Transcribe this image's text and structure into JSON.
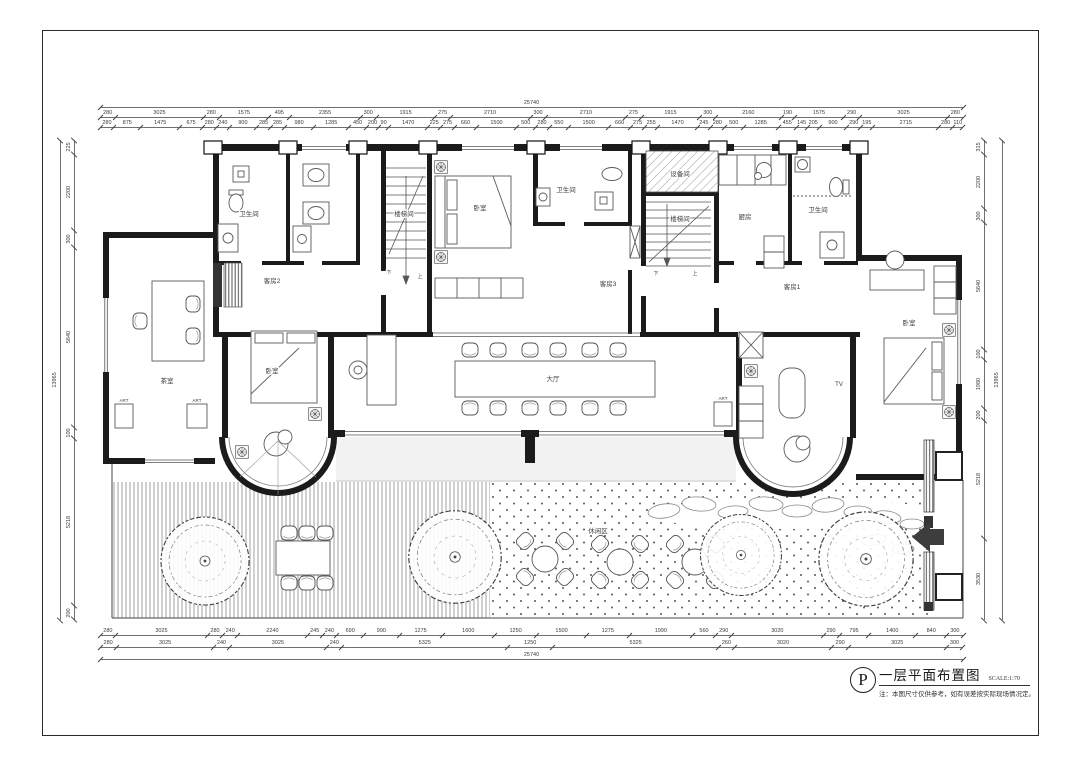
{
  "title_block": {
    "letter": "P",
    "title": "一层平面布置图",
    "scale": "SCALE:1:70",
    "note": "注：本图尺寸仅供参考，如有误差按实际现场情况定。"
  },
  "rooms": {
    "bath_tl": "卫生间",
    "bath_tm": "卫生间",
    "bath_tr": "卫生间",
    "stair_left": "楼梯间",
    "stair_right": "楼梯间",
    "equipment": "设备间",
    "kitchen": "厨房",
    "bedroom_top": "卧室",
    "bedroom_left": "卧室",
    "bedroom_right": "卧室",
    "guest1": "客房1",
    "guest2": "客房2",
    "guest3": "客房3",
    "tea": "茶室",
    "hall": "大厅",
    "leisure": "休闲区",
    "tv": "TV",
    "art": "ART",
    "up": "上",
    "down": "下"
  },
  "dimensions": {
    "top_total": [
      "25740"
    ],
    "top_mid": [
      "280",
      "3025",
      "280",
      "1575",
      "495",
      "2355",
      "300",
      "1915",
      "275",
      "2710",
      "300",
      "2710",
      "275",
      "1915",
      "300",
      "2160",
      "190",
      "1575",
      "290",
      "3025",
      "280"
    ],
    "top_fine": [
      "280",
      "875",
      "1475",
      "675",
      "280",
      "240",
      "900",
      "285",
      "285",
      "980",
      "1285",
      "450",
      "200",
      "90",
      "1470",
      "225",
      "275",
      "660",
      "1500",
      "500",
      "280",
      "550",
      "1500",
      "660",
      "275",
      "255",
      "1470",
      "245",
      "280",
      "500",
      "1285",
      "455",
      "145",
      "205",
      "900",
      "290",
      "195",
      "2715",
      "280",
      "110"
    ],
    "bottom_fine": [
      "280",
      "3025",
      "280",
      "240",
      "2240",
      "245",
      "240",
      "690",
      "990",
      "1275",
      "1600",
      "1250",
      "1500",
      "1275",
      "1990",
      "560",
      "290",
      "3020",
      "290",
      "795",
      "1400",
      "840",
      "300"
    ],
    "bottom_mid": [
      "280",
      "3025",
      "240",
      "3025",
      "240",
      "5325",
      "1250",
      "5325",
      "260",
      "3020",
      "290",
      "3025",
      "300"
    ],
    "bottom_total": [
      "25740"
    ],
    "left_total": [
      "13965"
    ],
    "left_mid": [
      "225",
      "2200",
      "300",
      "5640",
      "100",
      "5218",
      "200"
    ],
    "right_mid": [
      "315",
      "2200",
      "300",
      "5640",
      "100",
      "1980",
      "200",
      "5218",
      "3530"
    ],
    "right_total": [
      "13965"
    ]
  },
  "colors": {
    "wall": "#1b1b1b",
    "thin_line": "#555555",
    "dim_line": "#707070",
    "paper": "#ffffff"
  }
}
